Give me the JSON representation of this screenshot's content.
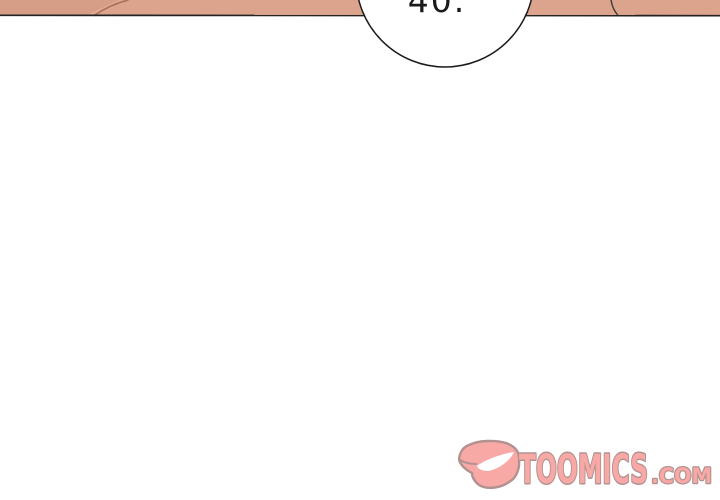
{
  "page": {
    "width": 720,
    "height": 500,
    "background": "#FFFFFF"
  },
  "comic_panel": {
    "speech_bubble": {
      "text": "40."
    },
    "colors": {
      "skin": "#DCA48D",
      "skin_shadow": "#D69D87",
      "skin_highlight": "#E6AF95",
      "fold_line": "#A9705A",
      "panel_edge": "#222222",
      "contour_line": "#3A3A3A",
      "bubble_fill": "#FFFFFF",
      "bubble_outline": "#1C1C1C",
      "text_color": "#1A1A1A"
    }
  },
  "watermark": {
    "brand": "TOOMICS",
    "domain_suffix": ".COM",
    "colors": {
      "fill": "#F8A8A5",
      "outline": "#B19290",
      "grin": "#FFFFFF"
    }
  }
}
